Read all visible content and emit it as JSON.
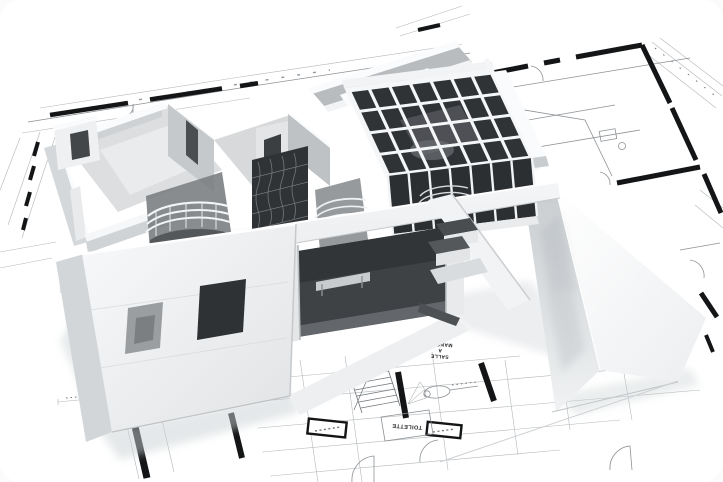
{
  "image": {
    "subject": "3D architectural house model standing on unrolled blueprint floor plans",
    "labels": {
      "toilette": "TOILETTE",
      "dining_line1": "SALLE",
      "dining_line2": "A",
      "dining_line3": "MANGER"
    },
    "palette": {
      "paper": "#ffffff",
      "blueprint_line": "#8d9296",
      "wall_ink": "#141516",
      "model_white": "#f5f6f7",
      "model_grey": "#d7d9db",
      "model_shadow": "#9fa3a6",
      "glazing_dark": "#303336"
    }
  }
}
